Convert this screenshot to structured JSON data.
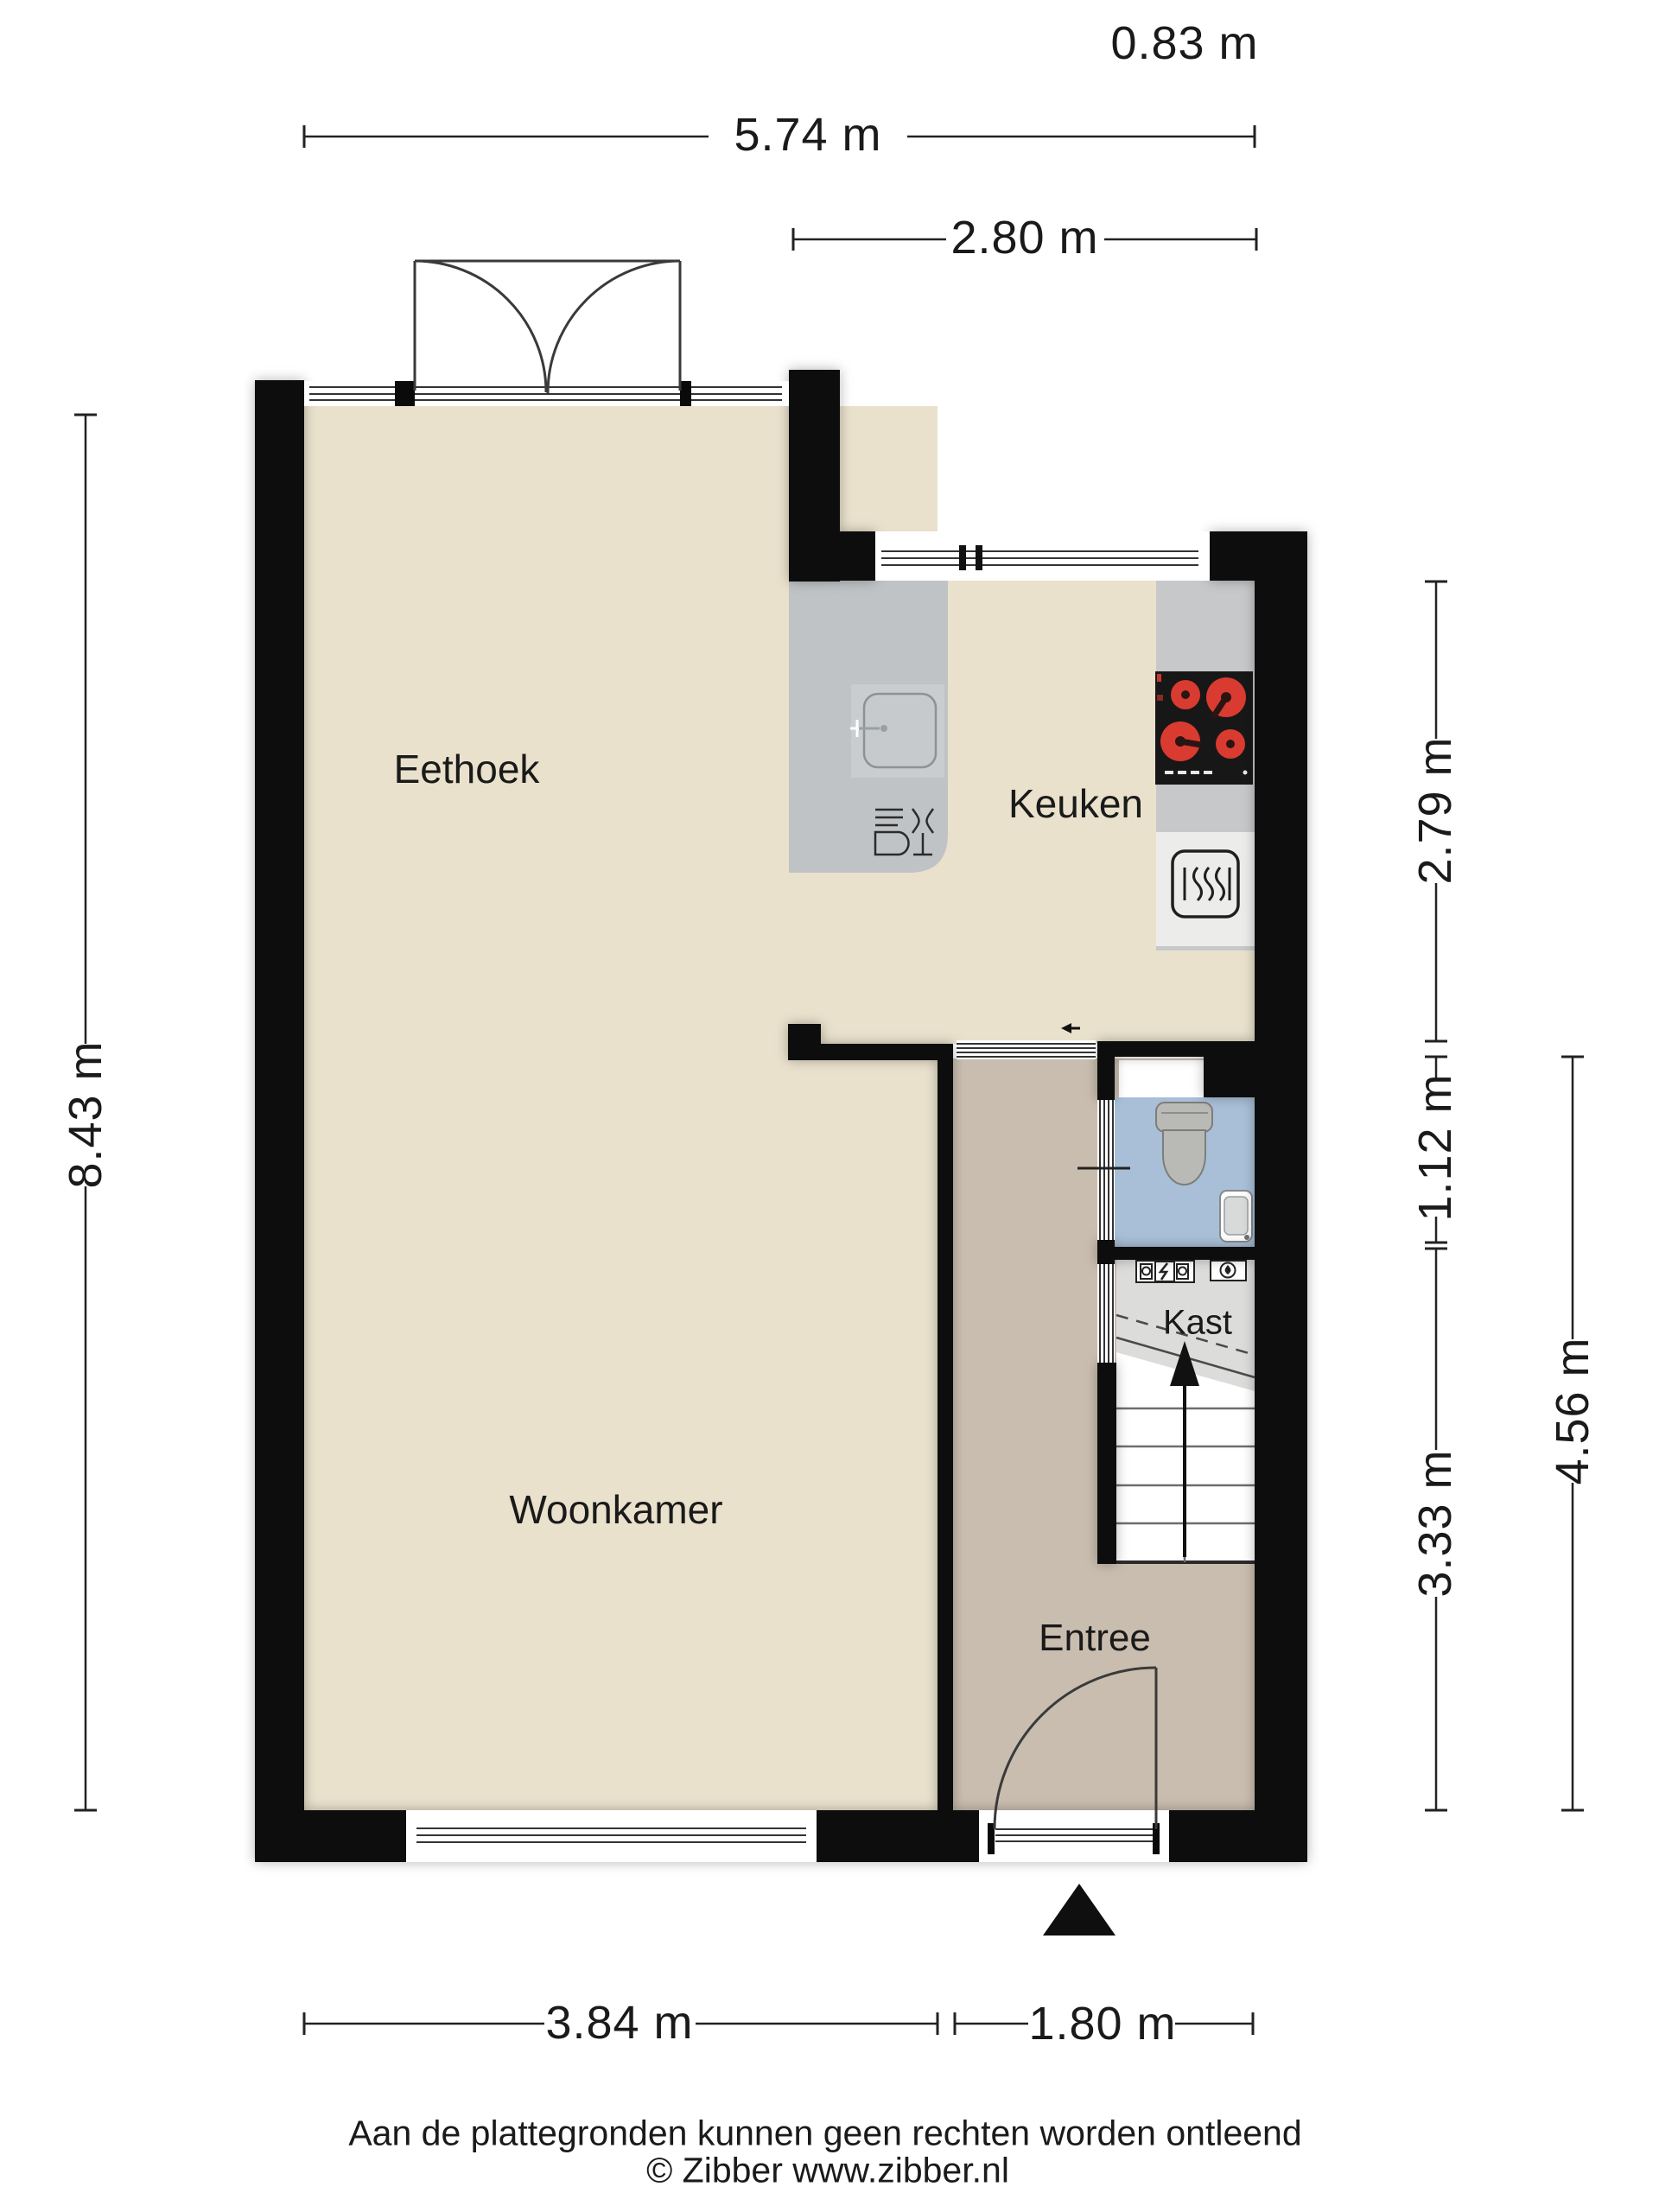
{
  "dimensions": {
    "top_right_small": "0.83 m",
    "top_width": "5.74 m",
    "kitchen_width": "2.80 m",
    "left_height": "8.43 m",
    "kitchen_height": "2.79 m",
    "toilet_height": "1.12 m",
    "hall_height": "3.33 m",
    "entree_total_height": "4.56 m",
    "living_width": "3.84 m",
    "entree_width": "1.80 m"
  },
  "rooms": {
    "dining": "Eethoek",
    "kitchen": "Keuken",
    "living": "Woonkamer",
    "closet": "Kast",
    "entry": "Entree"
  },
  "footer": {
    "disclaimer": "Aan de plattegronden kunnen geen rechten worden ontleend",
    "copyright": "© Zibber www.zibber.nl"
  },
  "colors": {
    "wall": "#0a0a0a",
    "floor_living": "#e9e1cc",
    "floor_hall": "#c9bdaf",
    "floor_toilet": "#a9bfd8",
    "floor_closet": "#dcdcda",
    "counter_gray": "#bfc3c5",
    "burner_red": "#d93b30"
  },
  "icons": [
    "sink-icon",
    "dishwasher-icon",
    "stove-icon",
    "oven-icon",
    "toilet-icon",
    "washbasin-icon",
    "boiler-icon",
    "water-heater-icon",
    "stairs-up-arrow-icon",
    "entrance-triangle-icon",
    "door-swing-arc-icon",
    "window-glazing-icon",
    "slide-arrow-icon"
  ]
}
